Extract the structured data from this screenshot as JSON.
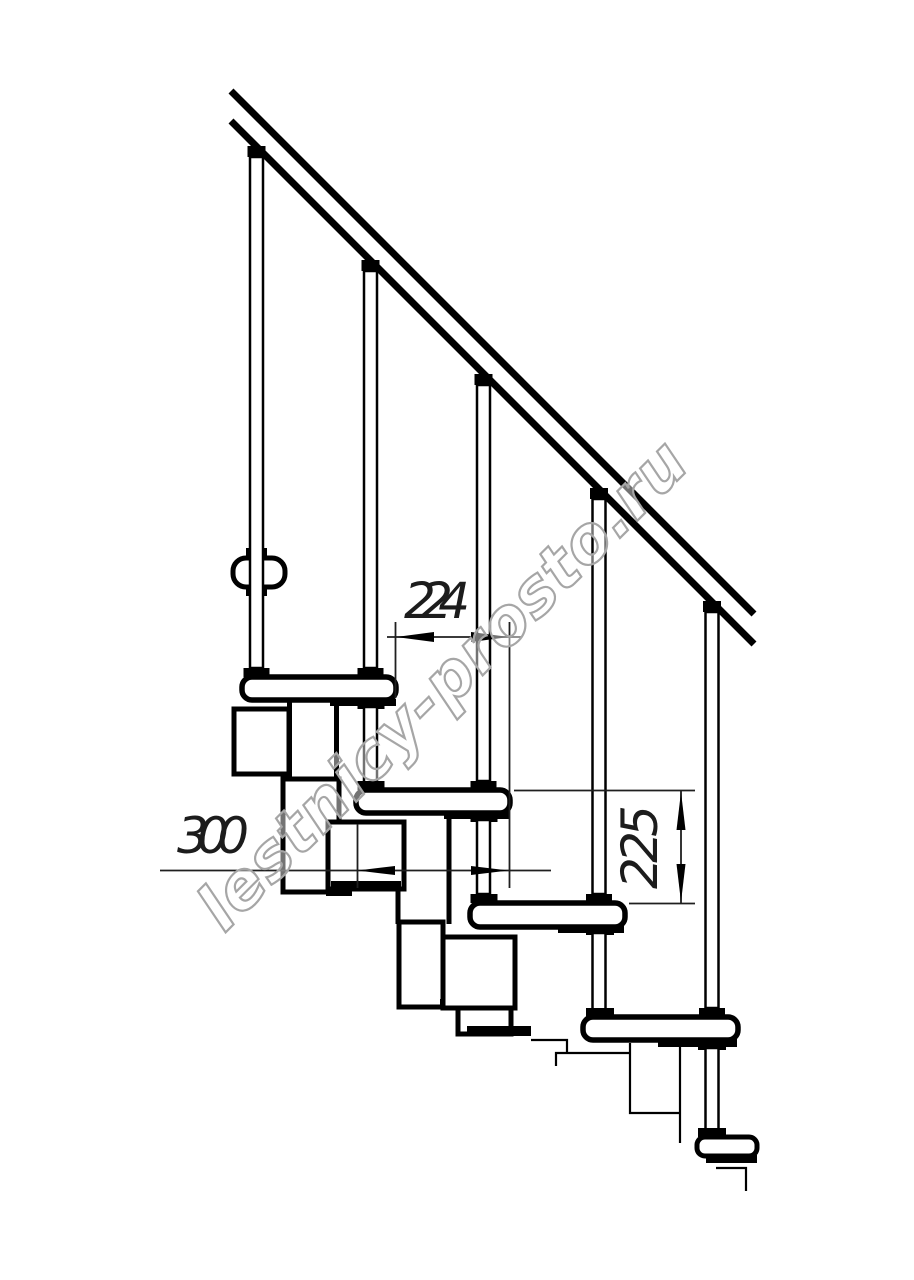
{
  "drawing": {
    "type": "technical-line-drawing",
    "subject": "Modular staircase fragment, side elevation with handrail",
    "background": "#ffffff",
    "line_color": "#000000",
    "dimension_color": "#1f1f1f"
  },
  "dimensions": {
    "run": "224",
    "tread_depth": "300",
    "rise": "225"
  },
  "watermark": {
    "text": "lestnicy-prosto.ru",
    "color": "#a6a6a6",
    "angle_deg": -45
  },
  "parts": {
    "handrail_count": 1,
    "baluster_count": 5,
    "tread_count": 4
  }
}
